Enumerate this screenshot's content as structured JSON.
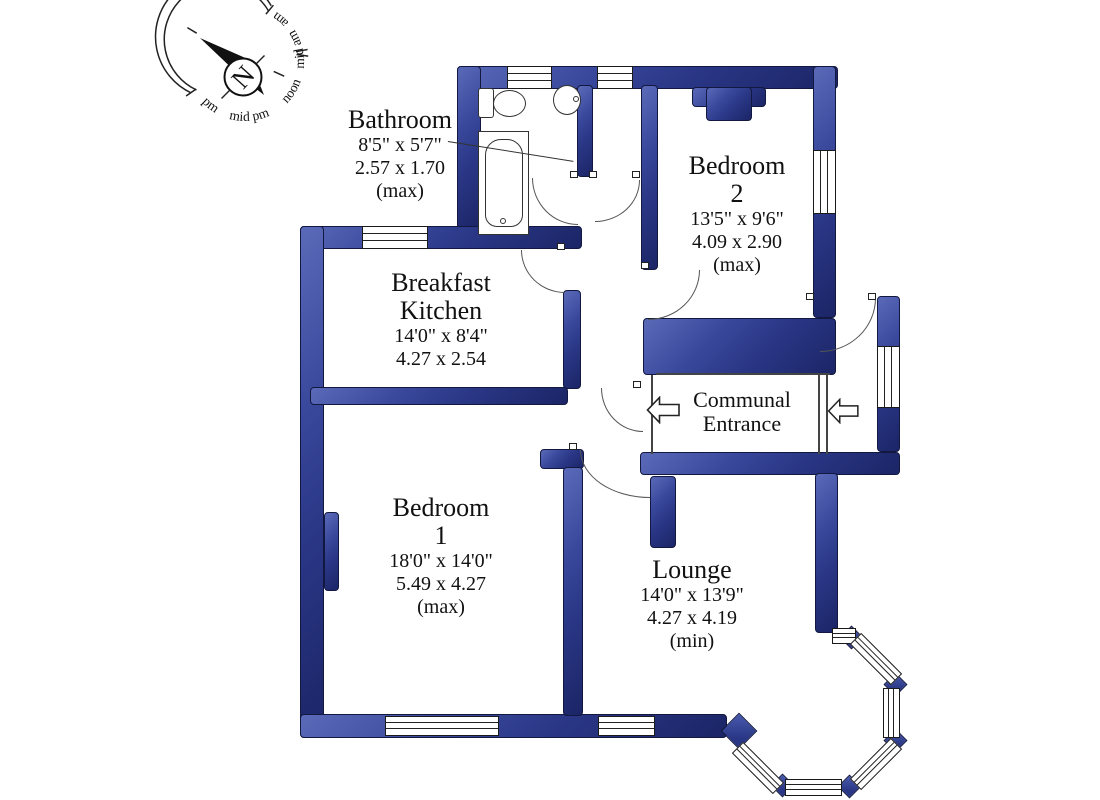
{
  "title": "Flat floor plan",
  "compass": {
    "north_letter": "N",
    "time_labels": [
      "pm",
      "mid pm",
      "noon",
      "mid am",
      "am"
    ]
  },
  "rooms": {
    "bathroom": {
      "name": "Bathroom",
      "dim_ft": "8'5\" x 5'7\"",
      "dim_m": "2.57 x 1.70",
      "note": "(max)"
    },
    "breakfast_kitchen": {
      "name_line1": "Breakfast",
      "name_line2": "Kitchen",
      "dim_ft": "14'0\" x 8'4\"",
      "dim_m": "4.27 x 2.54"
    },
    "bedroom2": {
      "name": "Bedroom",
      "number": "2",
      "dim_ft": "13'5\" x 9'6\"",
      "dim_m": "4.09 x 2.90",
      "note": "(max)"
    },
    "bedroom1": {
      "name": "Bedroom",
      "number": "1",
      "dim_ft": "18'0\" x 14'0\"",
      "dim_m": "5.49 x 4.27",
      "note": "(max)"
    },
    "lounge": {
      "name": "Lounge",
      "dim_ft": "14'0\" x 13'9\"",
      "dim_m": "4.27 x 4.19",
      "note": "(min)"
    },
    "communal_entrance": {
      "line1": "Communal",
      "line2": "Entrance"
    }
  },
  "colors": {
    "wall_blue": "#2f3d8f",
    "outline": "#333333",
    "background": "#ffffff"
  }
}
